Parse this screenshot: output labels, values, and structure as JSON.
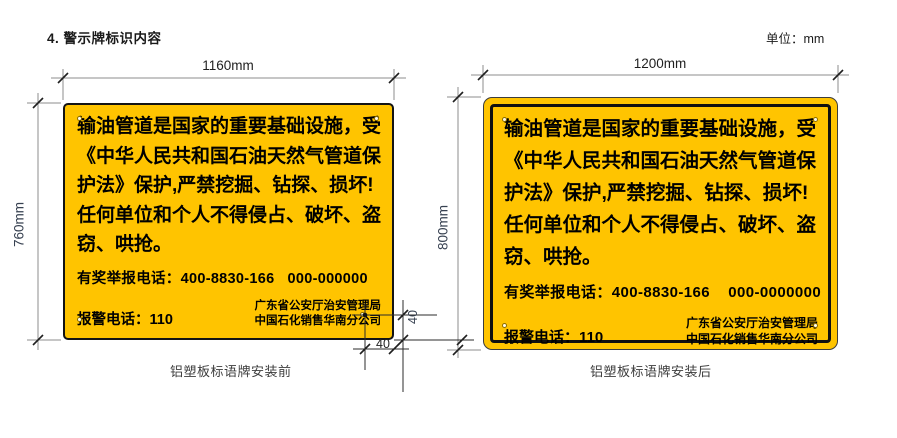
{
  "page": {
    "title": "4. 警示牌标识内容",
    "unit_label": "单位：mm"
  },
  "colors": {
    "sign_yellow": "#FFC400",
    "sign_text": "#000000",
    "dim_vertical_label": "#374151",
    "line_gray": "#8c8c8c"
  },
  "signs": [
    {
      "caption": "铝塑板标语牌安装前",
      "width_label": "1160mm",
      "height_label": "760mm",
      "lines": [
        "输油管道是国家的重要基础设施，受",
        "《中华人民共和国石油天然气管道保",
        "护法》保护,严禁挖掘、钻探、损坏!",
        "任何单位和个人不得侵占、破坏、盗",
        "窃、哄抢。"
      ],
      "reward_line": "有奖举报电话：400-8830-166   000-000000",
      "police_line": "报警电话：110",
      "org_lines": [
        "广东省公安厅治安管理局",
        "中国石化销售华南分公司"
      ]
    },
    {
      "caption": "铝塑板标语牌安装后",
      "width_label": "1200mm",
      "height_label": "800mm",
      "lines": [
        "输油管道是国家的重要基础设施，受",
        "《中华人民共和国石油天然气管道保",
        "护法》保护,严禁挖掘、钻探、损坏!",
        "任何单位和个人不得侵占、破坏、盗",
        "窃、哄抢。"
      ],
      "reward_line": "有奖举报电话：400-8830-166    000-0000000",
      "police_line": "报警电话：110",
      "org_lines": [
        "广东省公安厅治安管理局",
        "中国石化销售华南分公司"
      ]
    }
  ],
  "detail": {
    "hole_offset_vertical": "40",
    "hole_offset_horizontal": "40"
  }
}
